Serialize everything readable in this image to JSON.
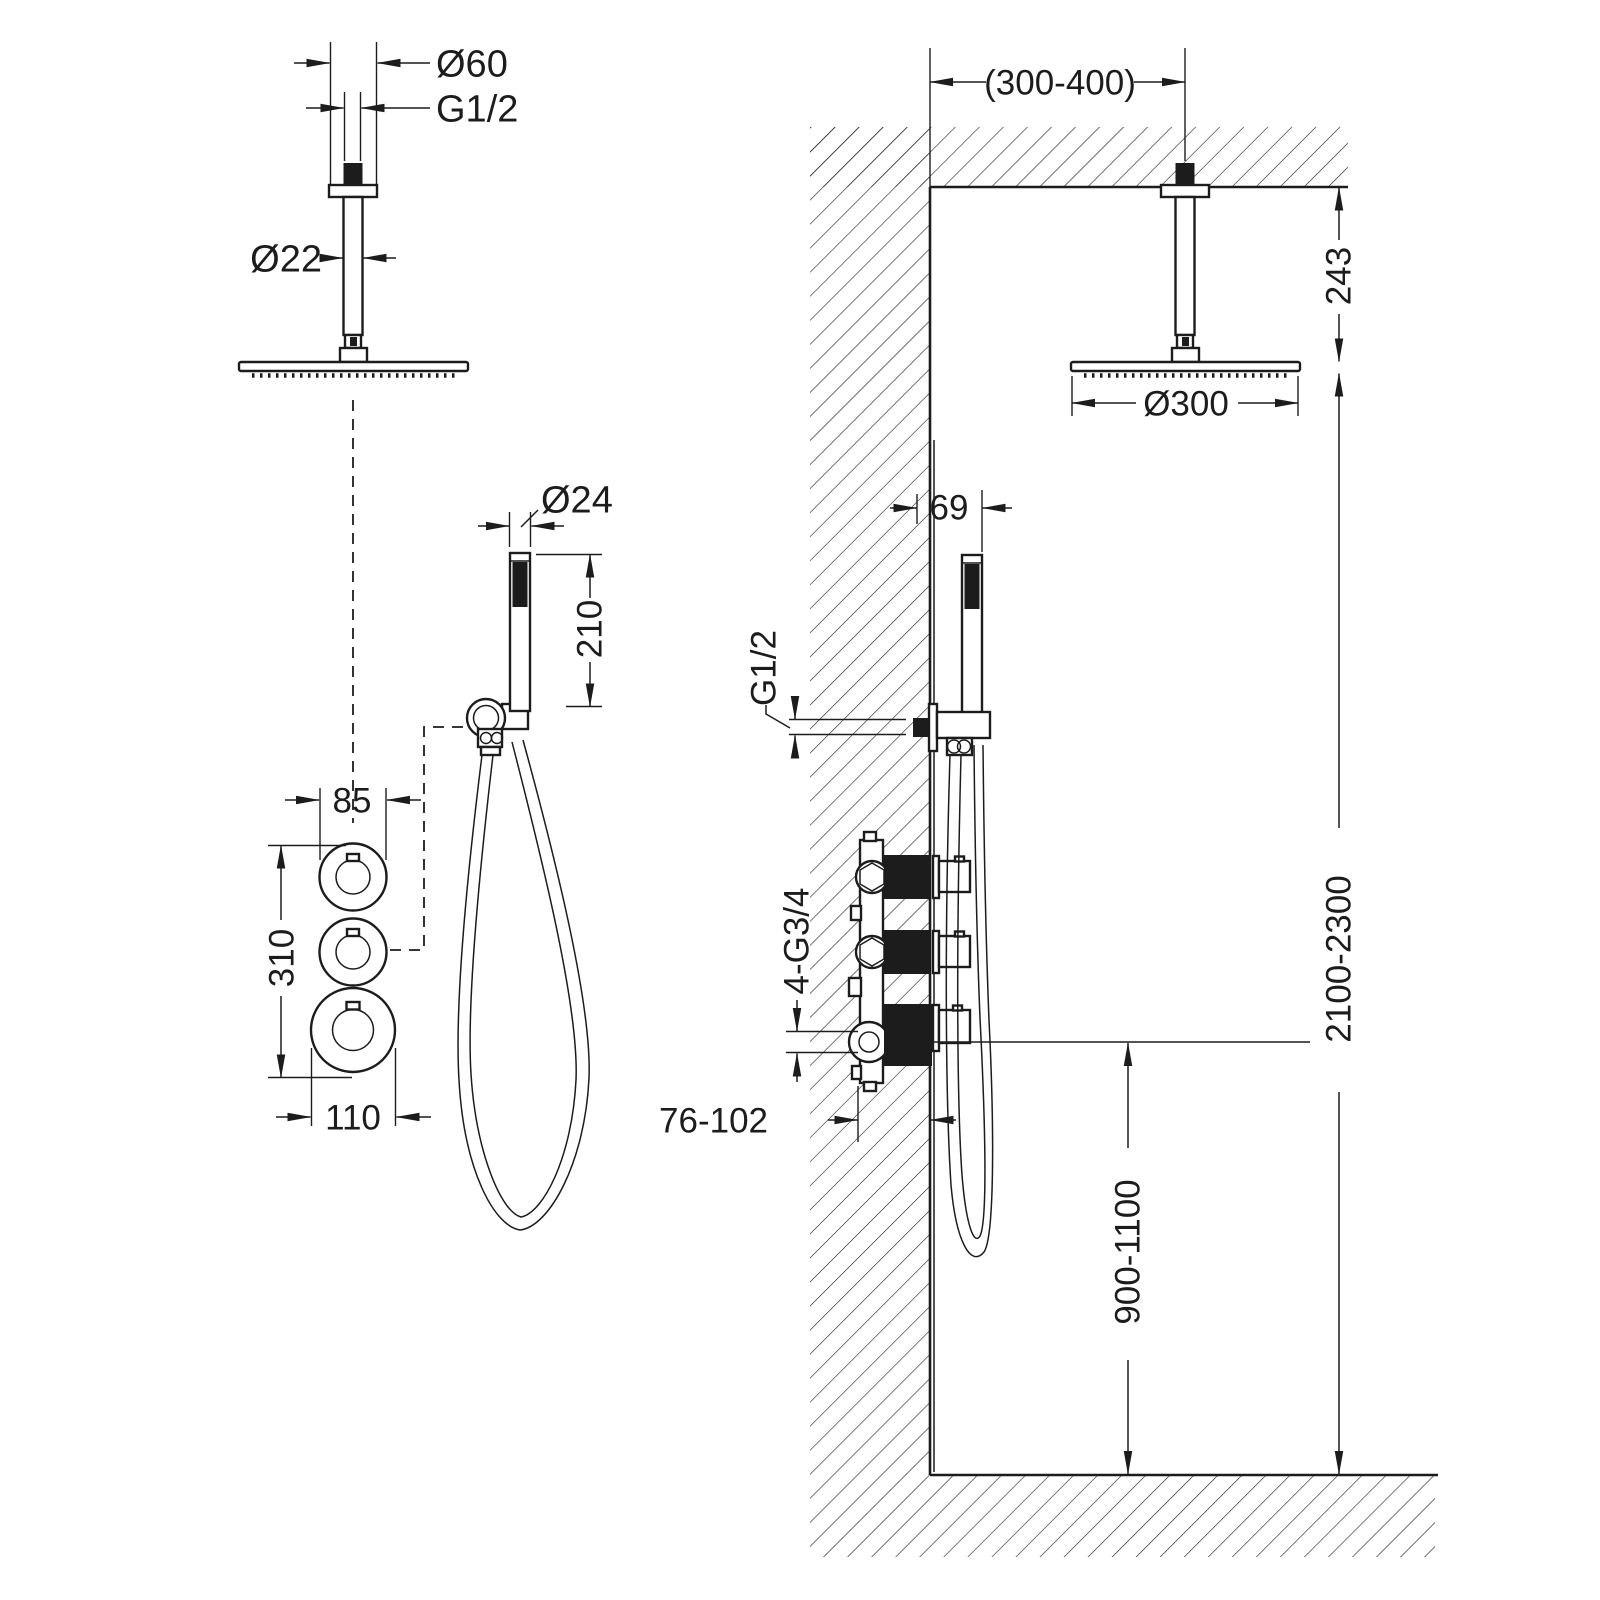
{
  "page": {
    "background": "#ffffff",
    "ink_color": "#1c1c1c",
    "drawing_type": "shower-system-installation-dimensions"
  },
  "front_view": {
    "dims": {
      "head_flange_diameter": "Ø60",
      "head_thread": "G1/2",
      "arm_diameter": "Ø22",
      "handshower_diameter": "Ø24",
      "handshower_length": "210",
      "valve_knob_small_diameter": "85",
      "valve_knob_spacing": "310",
      "valve_knob_large_diameter": "110"
    }
  },
  "side_view": {
    "dims": {
      "arm_offset_from_wall": "(300-400)",
      "head_drop_from_ceiling": "243",
      "head_diameter": "Ø300",
      "holder_offset_from_wall": "69",
      "outlet_thread": "G1/2",
      "valve_connection_threads": "4-G3/4",
      "recess_depth": "76-102",
      "valve_height_from_floor": "900-1100",
      "head_height_from_floor": "2100-2300"
    }
  }
}
